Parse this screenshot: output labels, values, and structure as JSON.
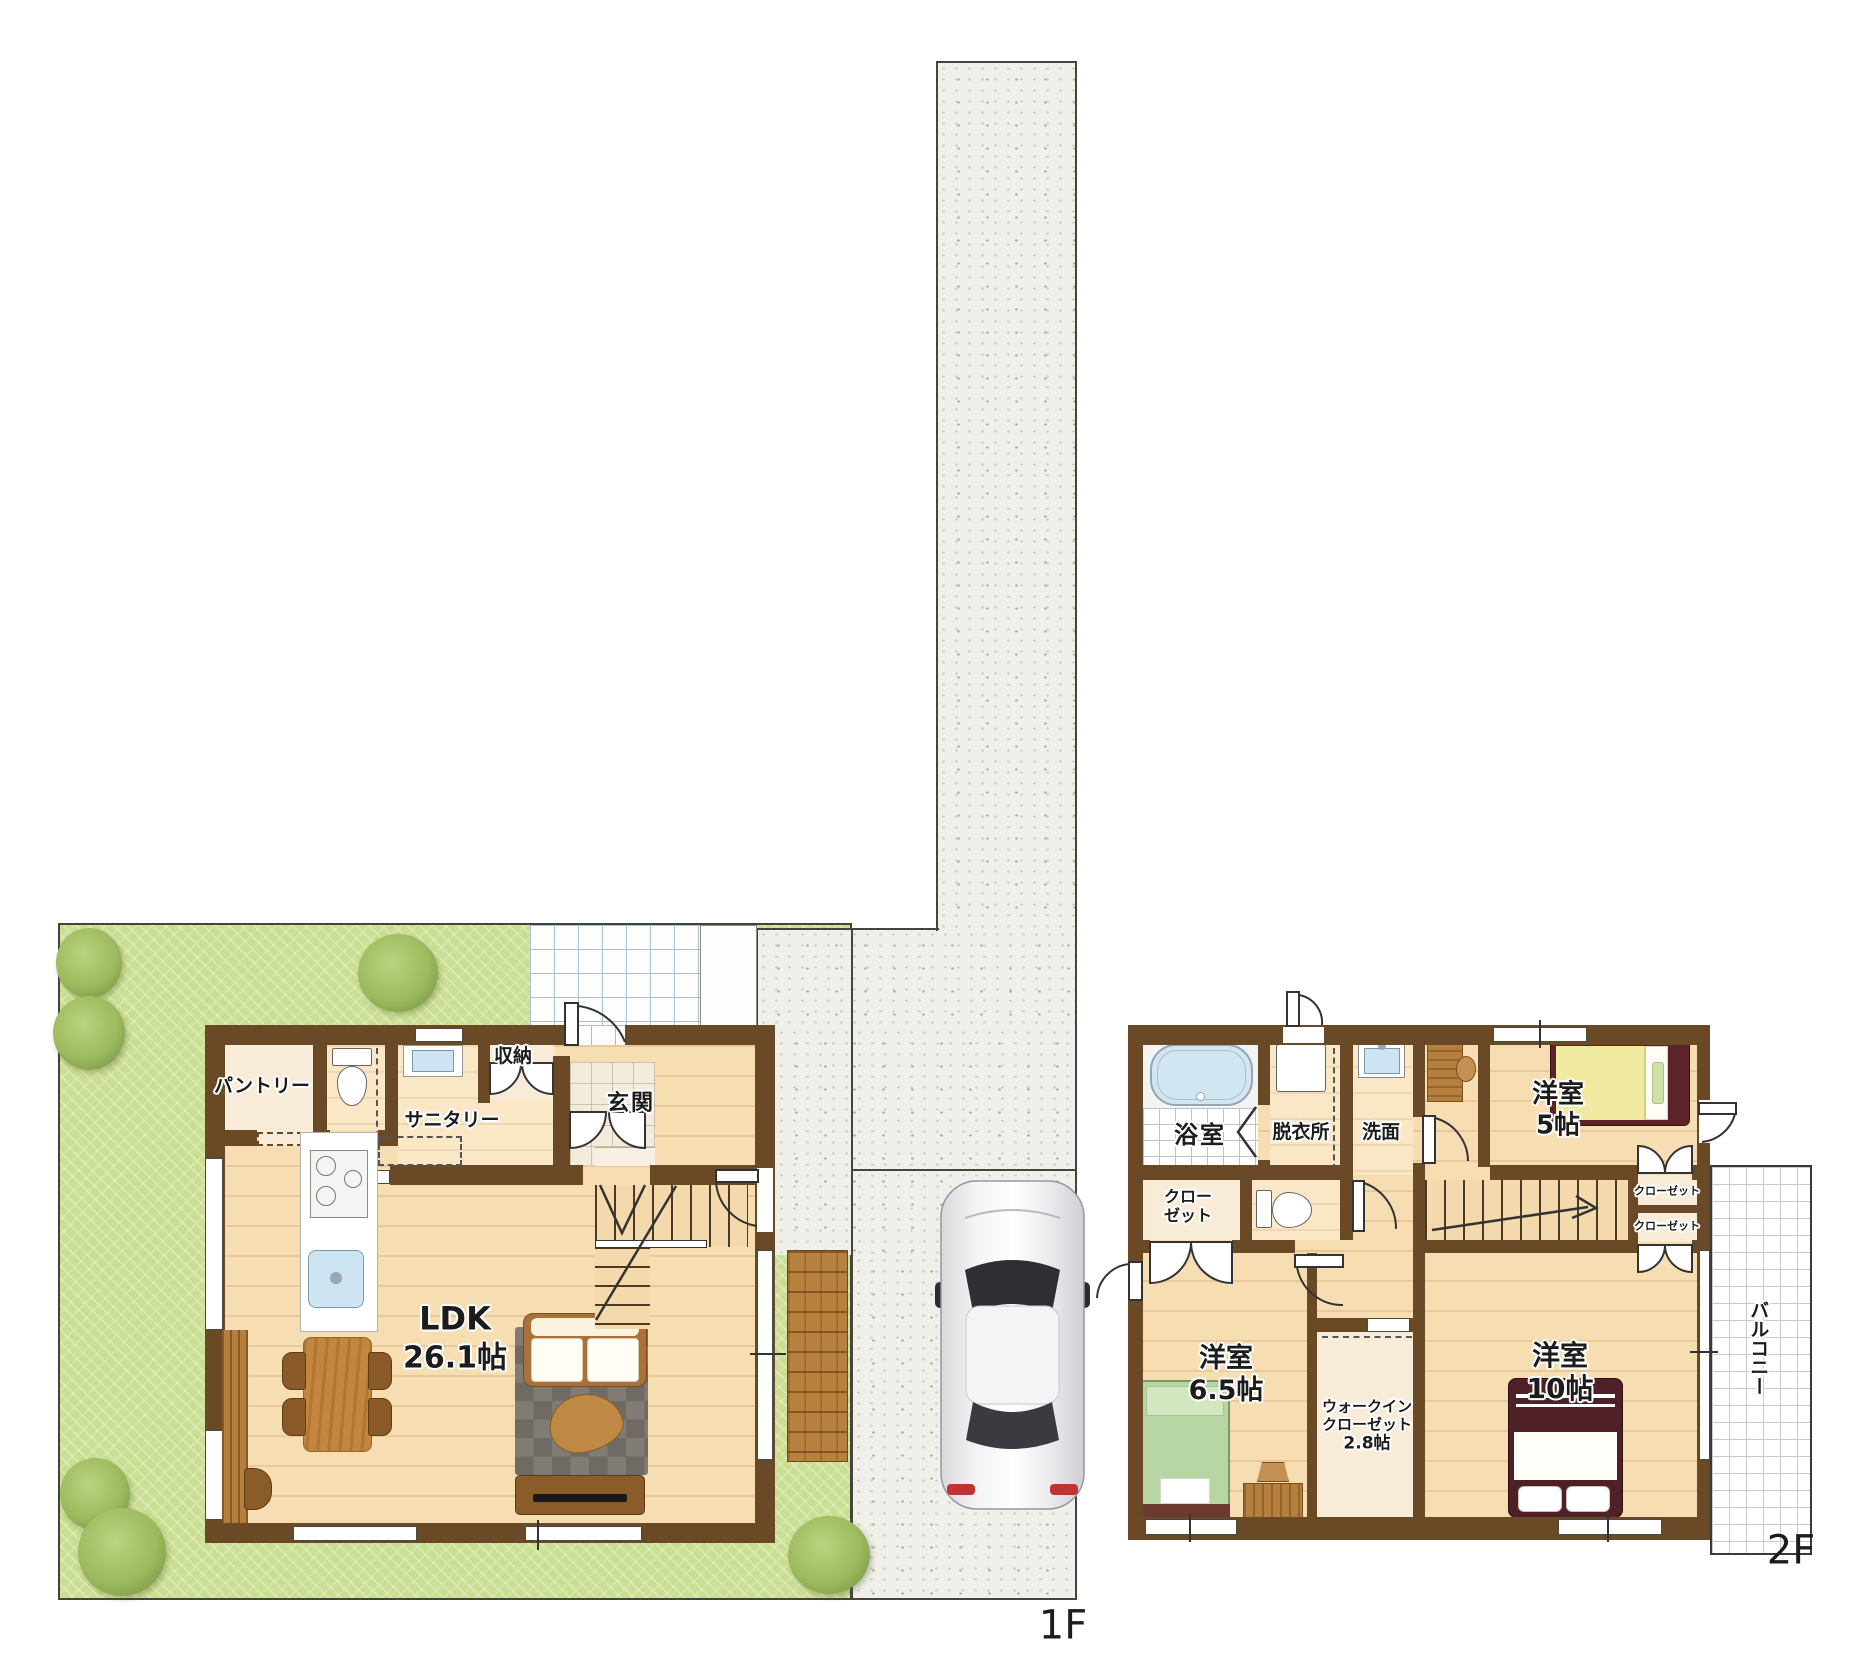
{
  "floor1": {
    "floor_label": "1F",
    "pantry": "パントリー",
    "sanitary": "サニタリー",
    "storage": "収納",
    "entrance": "玄関",
    "ldk_name": "LDK",
    "ldk_size": "26.1帖"
  },
  "floor2": {
    "floor_label": "2F",
    "bath": "浴室",
    "dressing": "脱衣所",
    "washroom": "洗面",
    "closet_small_line1": "クロー",
    "closet_small_line2": "ゼット",
    "bedroom5_name": "洋室",
    "bedroom5_size": "5帖",
    "closet_upper": "クローゼット",
    "closet_lower": "クローゼット",
    "bedroom65_name": "洋室",
    "bedroom65_size": "6.5帖",
    "wic_line1": "ウォークイン",
    "wic_line2": "クローゼット",
    "wic_line3": "2.8帖",
    "bedroom10_name": "洋室",
    "bedroom10_size": "10帖",
    "balcony": "バルコニー"
  },
  "colors": {
    "wall_brown": "#6a4a26",
    "floor_wood": "#f6ddb2",
    "garden_green": "#cbdf92",
    "concrete_gray": "#f1efe9",
    "water_blue": "#cde4f2",
    "rug_gray": "#76716b",
    "bed_green": "#b7d6a4",
    "bed_yellow": "#f0e9a0",
    "bed_maroon": "#4f2026",
    "deck_wood": "#b9813f"
  }
}
